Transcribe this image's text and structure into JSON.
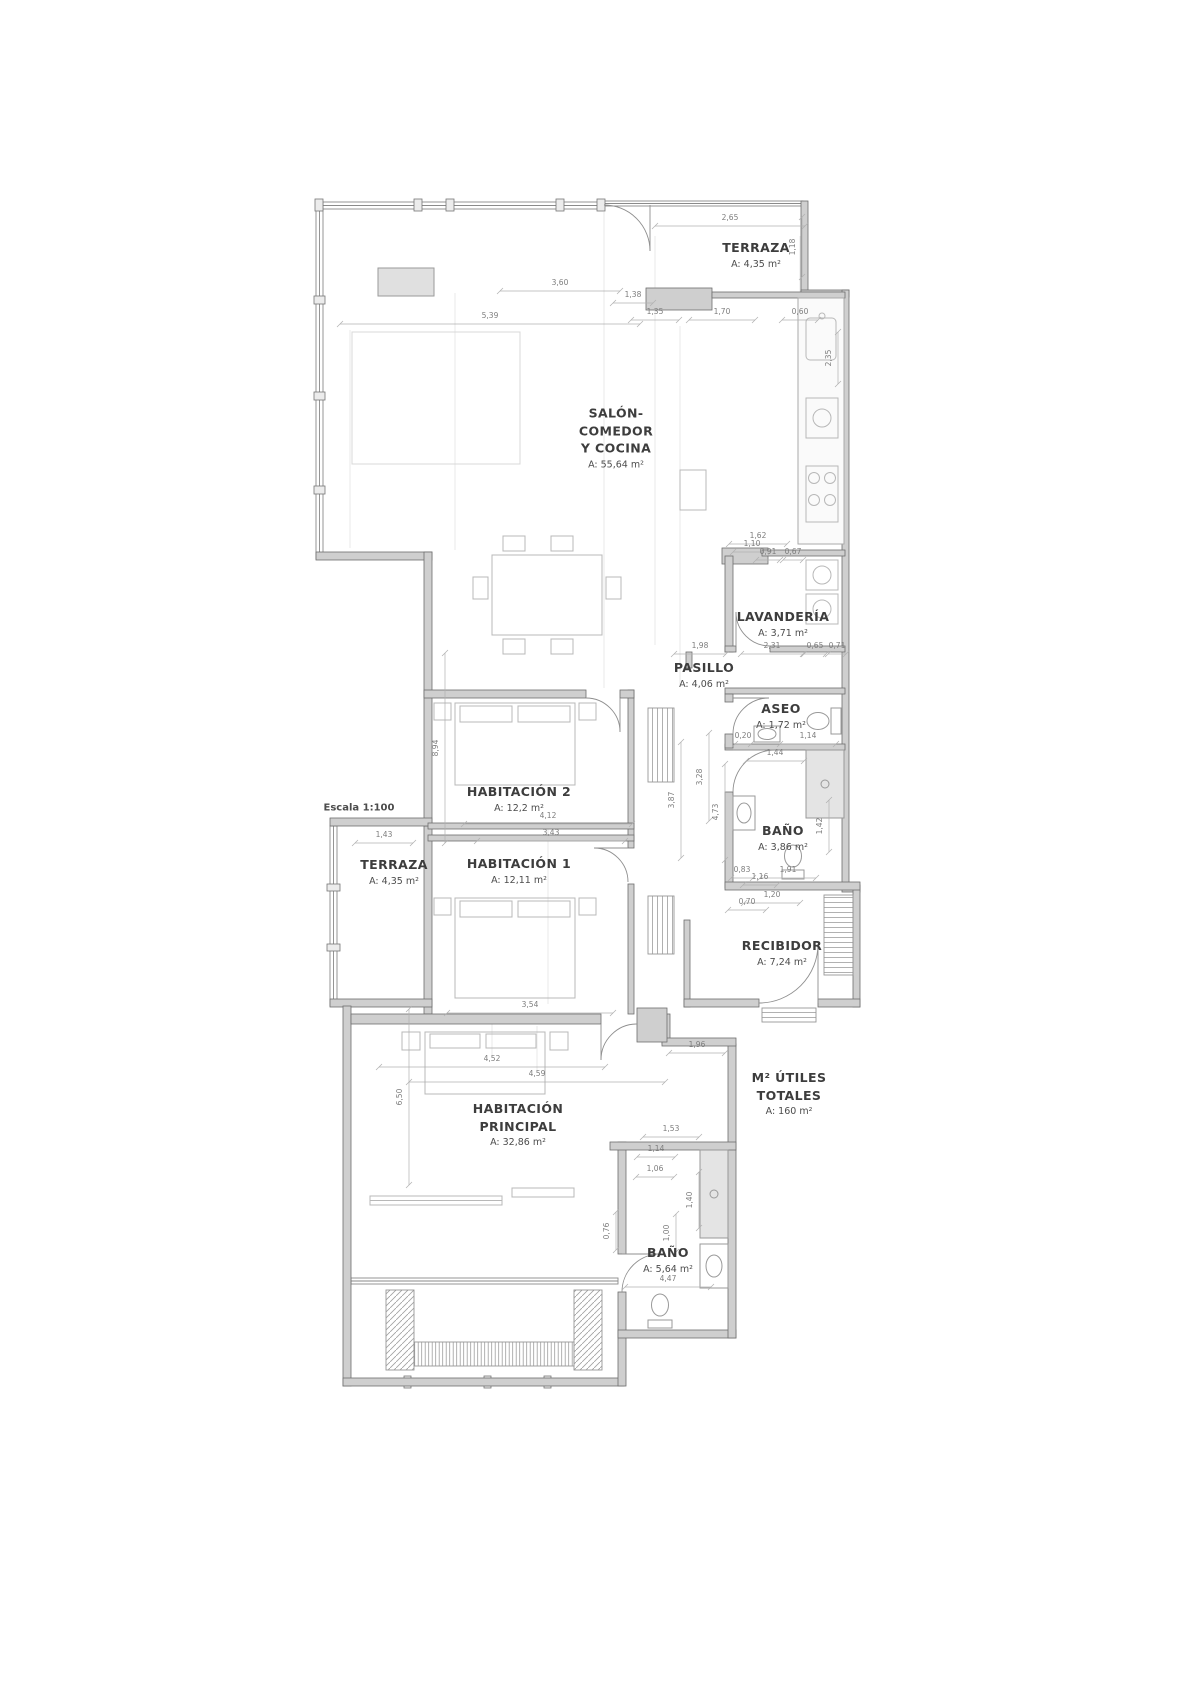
{
  "scale_note": "Escala 1:100",
  "rooms": [
    {
      "id": "terraza-top",
      "name": "TERRAZA",
      "area": "A: 4,35 m²"
    },
    {
      "id": "salon",
      "name": "SALÓN- COMEDOR Y COCINA",
      "area": "A: 55,64 m²"
    },
    {
      "id": "lavanderia",
      "name": "LAVANDERÍA",
      "area": "A: 3,71 m²"
    },
    {
      "id": "pasillo",
      "name": "PASILLO",
      "area": "A: 4,06 m²"
    },
    {
      "id": "aseo",
      "name": "ASEO",
      "area": "A: 1,72 m²"
    },
    {
      "id": "bano-1",
      "name": "BAÑO",
      "area": "A: 3,86 m²"
    },
    {
      "id": "habitacion-2",
      "name": "HABITACIÓN 2",
      "area": "A: 12,2 m²"
    },
    {
      "id": "habitacion-1",
      "name": "HABITACIÓN 1",
      "area": "A: 12,11 m²"
    },
    {
      "id": "terraza-left",
      "name": "TERRAZA",
      "area": "A: 4,35 m²"
    },
    {
      "id": "recibidor",
      "name": "RECIBIDOR",
      "area": "A: 7,24 m²"
    },
    {
      "id": "habitacion-principal",
      "name": "HABITACIÓN PRINCIPAL",
      "area": "A: 32,86 m²"
    },
    {
      "id": "m2-utiles-totales",
      "name": "M² ÚTILES TOTALES",
      "area": "A: 160 m²"
    },
    {
      "id": "bano-2",
      "name": "BAÑO",
      "area": "A: 5,64 m²"
    }
  ],
  "dimensions": [
    {
      "v": "2,65",
      "x": 730,
      "y": 222,
      "o": "h",
      "len": 150
    },
    {
      "v": "1,18",
      "x": 797,
      "y": 247,
      "o": "v",
      "len": 60
    },
    {
      "v": "1,38",
      "x": 633,
      "y": 299,
      "o": "h",
      "len": 40
    },
    {
      "v": "3,60",
      "x": 560,
      "y": 287,
      "o": "h",
      "len": 120
    },
    {
      "v": "5,39",
      "x": 490,
      "y": 320,
      "o": "h",
      "len": 300
    },
    {
      "v": "1,35",
      "x": 655,
      "y": 316,
      "o": "h",
      "len": 48
    },
    {
      "v": "1,70",
      "x": 722,
      "y": 316,
      "o": "h",
      "len": 66
    },
    {
      "v": "0,60",
      "x": 800,
      "y": 316,
      "o": "h",
      "len": 36
    },
    {
      "v": "2,35",
      "x": 833,
      "y": 358,
      "o": "v",
      "len": 52
    },
    {
      "v": "1,62",
      "x": 758,
      "y": 540,
      "o": "h",
      "len": 58
    },
    {
      "v": "1,10",
      "x": 752,
      "y": 548,
      "o": "h",
      "len": 38
    },
    {
      "v": "0,91",
      "x": 768,
      "y": 556,
      "o": "h",
      "len": 24
    },
    {
      "v": "0,67",
      "x": 793,
      "y": 556,
      "o": "h",
      "len": 20
    },
    {
      "v": "1,98",
      "x": 700,
      "y": 650,
      "o": "h",
      "len": 52
    },
    {
      "v": "2,31",
      "x": 772,
      "y": 650,
      "o": "h",
      "len": 62
    },
    {
      "v": "0,65",
      "x": 815,
      "y": 650,
      "o": "h",
      "len": 22
    },
    {
      "v": "0,71",
      "x": 837,
      "y": 650,
      "o": "h",
      "len": 18
    },
    {
      "v": "0,20",
      "x": 743,
      "y": 740,
      "o": "h",
      "len": 16
    },
    {
      "v": "1,14",
      "x": 808,
      "y": 740,
      "o": "h",
      "len": 56
    },
    {
      "v": "1,44",
      "x": 775,
      "y": 757,
      "o": "h",
      "len": 58
    },
    {
      "v": "1,91",
      "x": 788,
      "y": 874,
      "o": "h",
      "len": 56
    },
    {
      "v": "0,83",
      "x": 742,
      "y": 874,
      "o": "h",
      "len": 22
    },
    {
      "v": "1,16",
      "x": 760,
      "y": 881,
      "o": "h",
      "len": 34
    },
    {
      "v": "1,20",
      "x": 772,
      "y": 899,
      "o": "h",
      "len": 56
    },
    {
      "v": "0,70",
      "x": 747,
      "y": 906,
      "o": "h",
      "len": 38
    },
    {
      "v": "4,12",
      "x": 548,
      "y": 820,
      "o": "h",
      "len": 168
    },
    {
      "v": "3,43",
      "x": 551,
      "y": 837,
      "o": "h",
      "len": 148
    },
    {
      "v": "8,94",
      "x": 440,
      "y": 748,
      "o": "v",
      "len": 190
    },
    {
      "v": "1,43",
      "x": 384,
      "y": 839,
      "o": "h",
      "len": 58
    },
    {
      "v": "3,87",
      "x": 676,
      "y": 800,
      "o": "v",
      "len": 116
    },
    {
      "v": "3,28",
      "x": 704,
      "y": 777,
      "o": "v",
      "len": 88
    },
    {
      "v": "4,73",
      "x": 720,
      "y": 812,
      "o": "v",
      "len": 96
    },
    {
      "v": "1,42",
      "x": 824,
      "y": 826,
      "o": "v",
      "len": 52
    },
    {
      "v": "3,54",
      "x": 530,
      "y": 1009,
      "o": "h",
      "len": 166
    },
    {
      "v": "4,52",
      "x": 492,
      "y": 1063,
      "o": "h",
      "len": 226
    },
    {
      "v": "4,59",
      "x": 537,
      "y": 1078,
      "o": "h",
      "len": 256
    },
    {
      "v": "1,96",
      "x": 697,
      "y": 1049,
      "o": "h",
      "len": 56
    },
    {
      "v": "6,50",
      "x": 404,
      "y": 1097,
      "o": "v",
      "len": 176
    },
    {
      "v": "1,53",
      "x": 671,
      "y": 1133,
      "o": "h",
      "len": 56
    },
    {
      "v": "1,14",
      "x": 656,
      "y": 1153,
      "o": "h",
      "len": 38
    },
    {
      "v": "1,06",
      "x": 655,
      "y": 1173,
      "o": "h",
      "len": 38
    },
    {
      "v": "1,40",
      "x": 694,
      "y": 1200,
      "o": "v",
      "len": 56
    },
    {
      "v": "1,00",
      "x": 671,
      "y": 1233,
      "o": "v",
      "len": 38
    },
    {
      "v": "0,76",
      "x": 611,
      "y": 1231,
      "o": "v",
      "len": 38
    },
    {
      "v": "4,47",
      "x": 668,
      "y": 1283,
      "o": "h",
      "len": 86
    }
  ]
}
